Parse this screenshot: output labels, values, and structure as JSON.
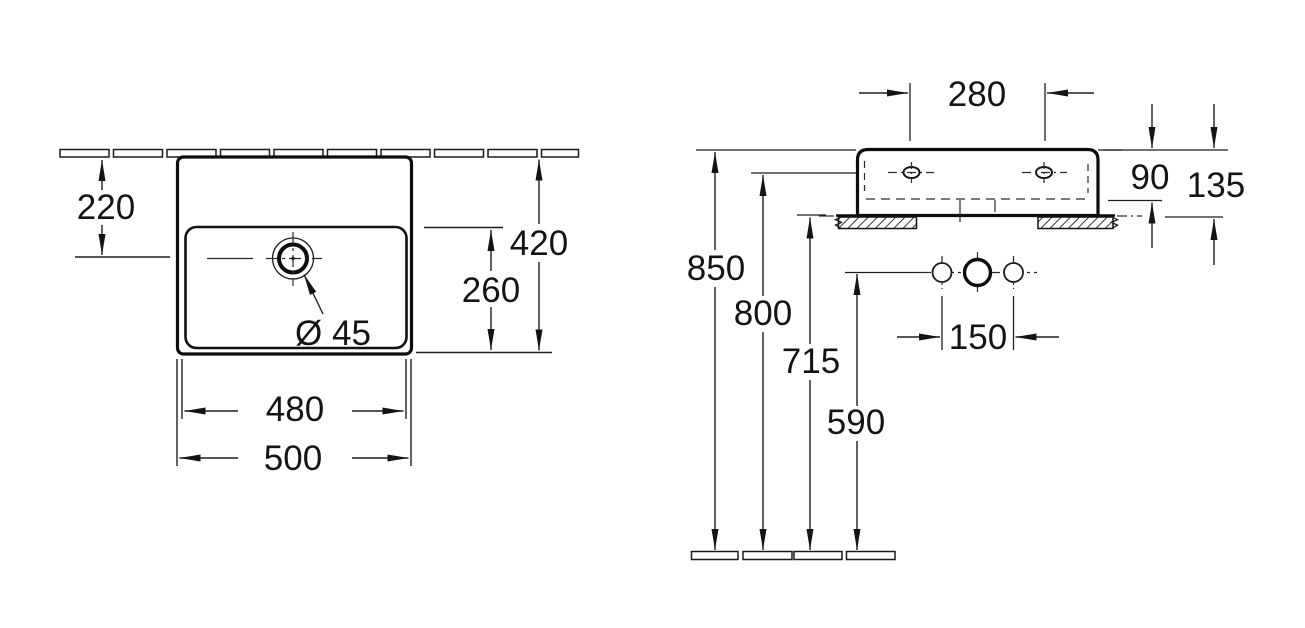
{
  "drawing": {
    "kind": "washbasin installation dimension drawing",
    "units_implied": "mm"
  },
  "views": {
    "plan": {
      "wall_to_drain": "220",
      "depth_total": "420",
      "bowl_depth": "260",
      "width_inner": "480",
      "width_total": "500",
      "drain_diameter": "Ø 45"
    },
    "elevation": {
      "faucet_hole_spacing": "280",
      "front_height": "90",
      "total_height": "135",
      "rim_height": "850",
      "fixing_hole_height": "800",
      "underside_height": "715",
      "outlet_height": "590",
      "outlet_spacing": "150"
    }
  }
}
